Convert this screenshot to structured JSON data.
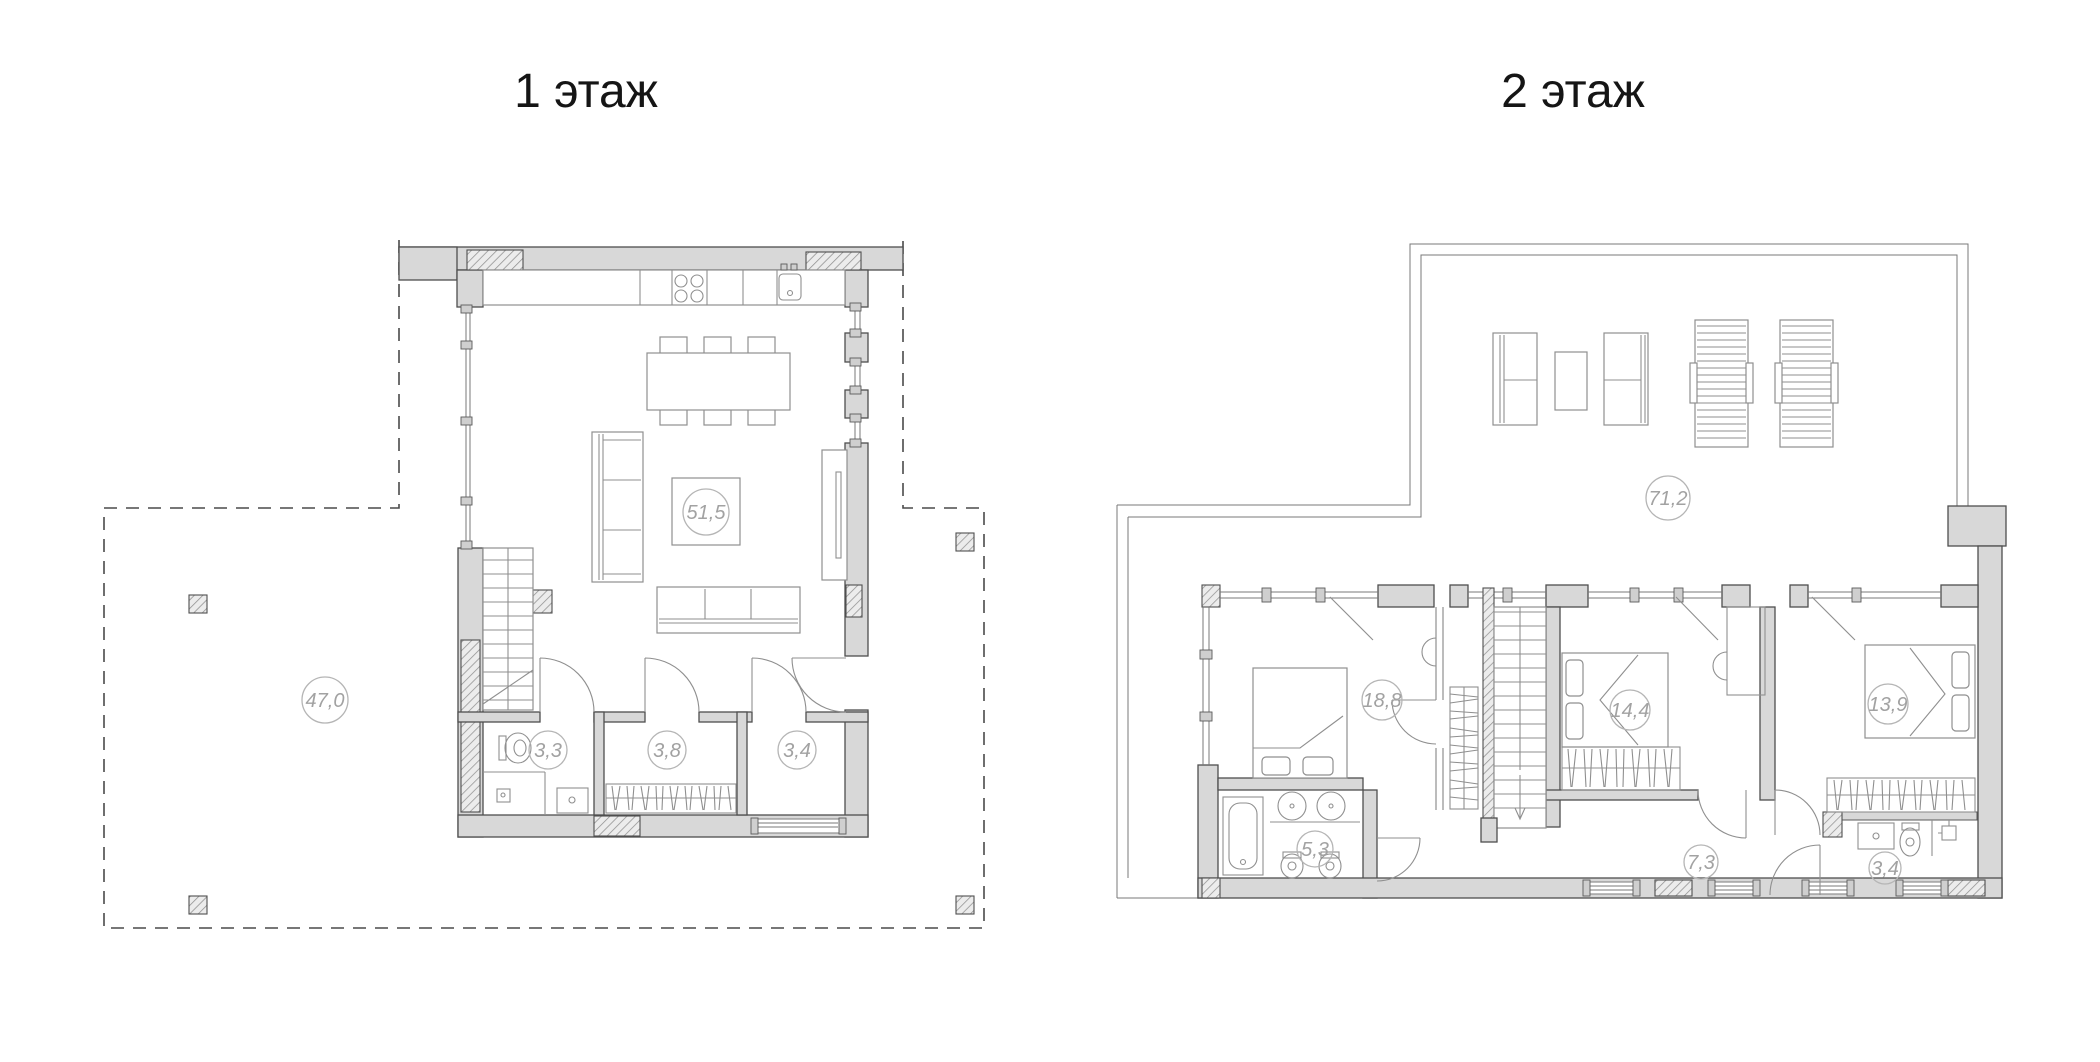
{
  "page": {
    "background": "#ffffff"
  },
  "colors": {
    "wall_fill": "#d8d8d8",
    "line": "#4f4f4f",
    "furniture_line": "#8f8f8f",
    "label_text": "#a2a2a2",
    "label_circle": "#b5b5b5",
    "title_text": "#151515"
  },
  "floor1": {
    "title": "1 этаж",
    "areas": {
      "terrace": "47,0",
      "living_kitchen": "51,5",
      "bathroom": "3,3",
      "wardrobe": "3,8",
      "hall": "3,4"
    }
  },
  "floor2": {
    "title": "2 этаж",
    "areas": {
      "hall_open_space": "71,2",
      "bedroom_left": "18,8",
      "bedroom_middle": "14,4",
      "bedroom_right": "13,9",
      "bathroom_left": "5,3",
      "corridor": "7,3",
      "bathroom_right": "3,4"
    }
  }
}
